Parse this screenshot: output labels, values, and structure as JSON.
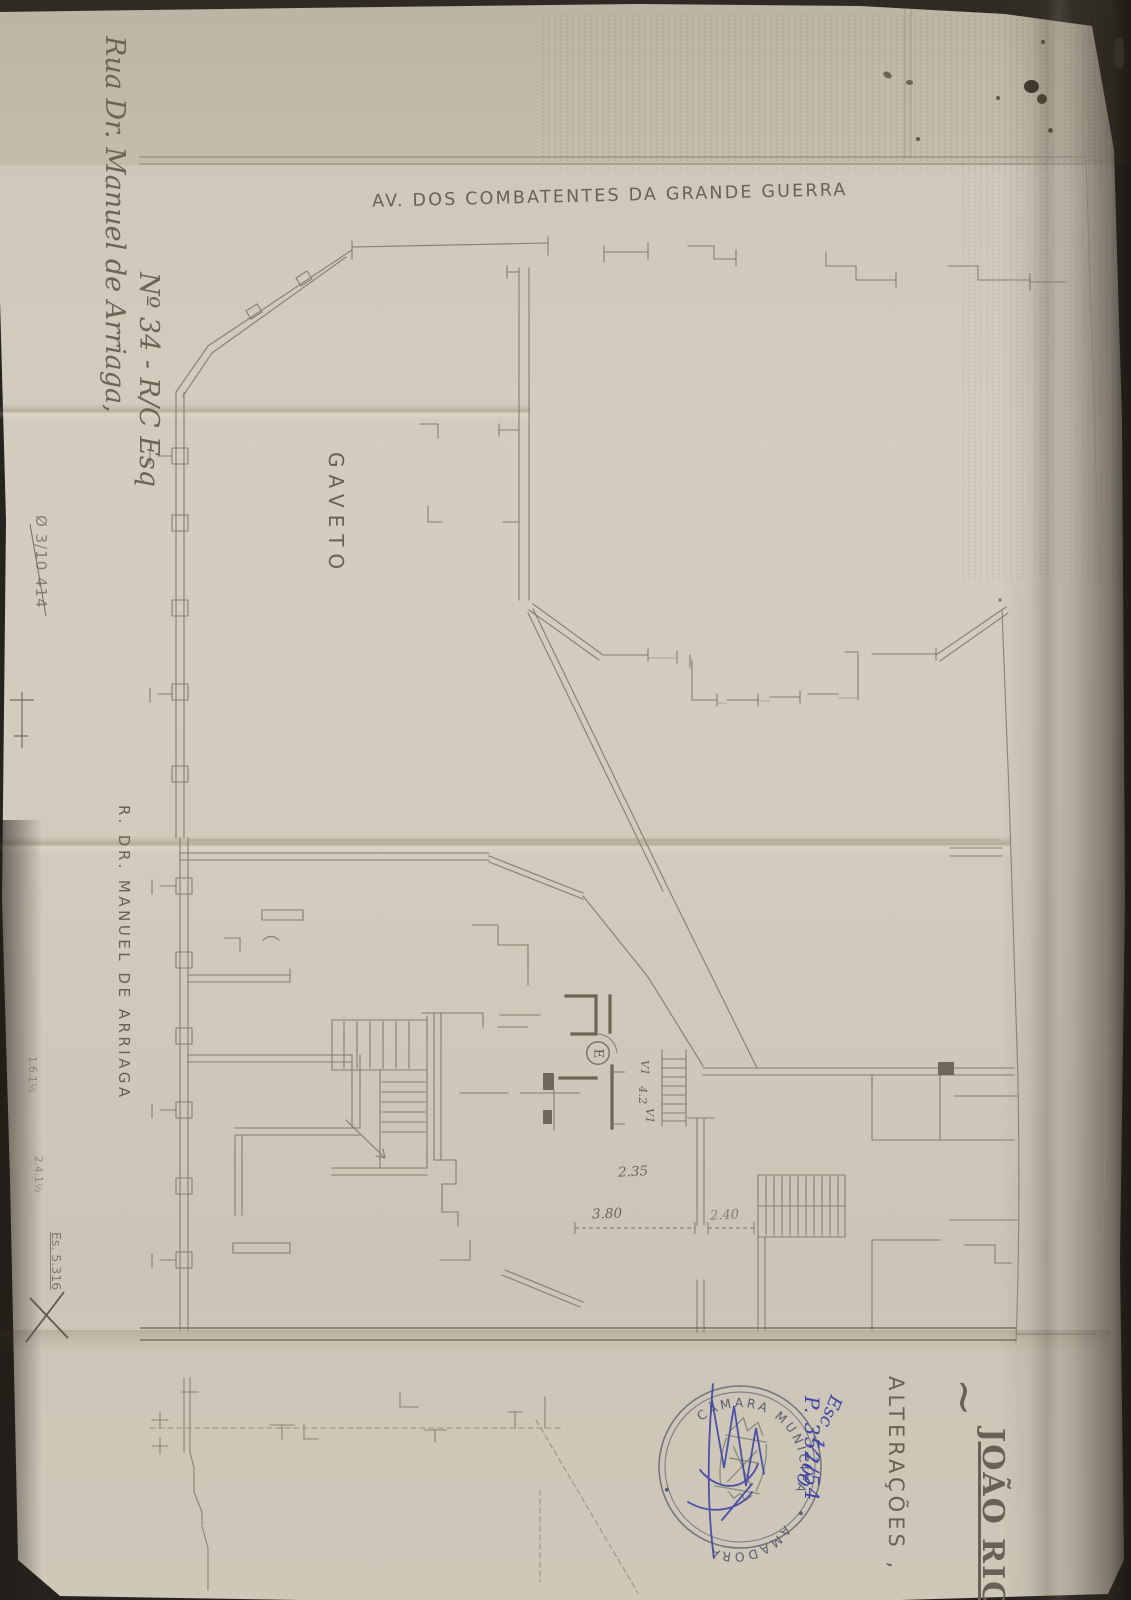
{
  "colors": {
    "paper": "#cfc8ba",
    "background": "#26231e",
    "drawing_ink": "#8b8274",
    "pencil": "#756c5d",
    "blue_ink": "#3e45a6",
    "stamp_ink": "#5c6372"
  },
  "labels": {
    "street_top": "AV. DOS COMBATENTES DA GRANDE GUERRA",
    "corner": "GAVETO",
    "street_left": "R. DR. MANUEL DE ARRIAGA"
  },
  "handwriting": {
    "address_line1": "Rua Dr. Manuel de Arriaga,",
    "address_line2": "Nº 34 - R/C Esq",
    "edge_note": "Ø 3/10 414",
    "note_a": "1.6.1½",
    "note_b": "2.4.1½",
    "corner_note": "Es. 5.316",
    "process_number": "P. 352/54",
    "scale_note": "Esc. 1/100"
  },
  "titleblock": {
    "tilde": "~",
    "owner_name": "JOÃO RIC",
    "subject": "ALTERAÇÕES ,"
  },
  "stamp": {
    "arc_top": "CÂMARA MUNICIPAL DA",
    "arc_bottom": "AMADORA"
  },
  "dimensions": {
    "d_235": "2.35",
    "d_380": "3.80",
    "d_240": "2.40",
    "v1_top": "V1",
    "v_mid": "4.2",
    "v1_bottom": "V1",
    "room_letter": "E"
  }
}
